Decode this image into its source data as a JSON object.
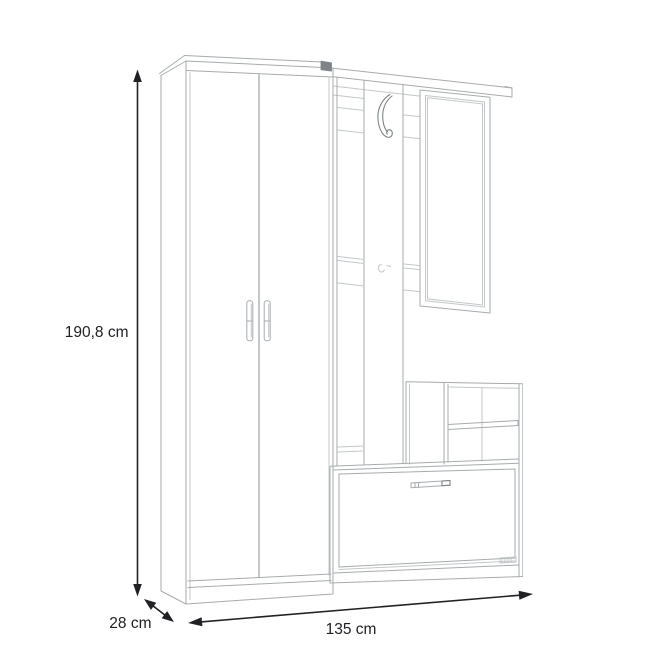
{
  "drawing": {
    "kind": "furniture dimension line drawing",
    "dimensions": {
      "height_label": "190,8 cm",
      "depth_label": "28 cm",
      "width_label": "135 cm"
    },
    "colors": {
      "line": "#a6abad",
      "light": "#c3c7c9",
      "dark": "#7e8487",
      "dim": "#202124",
      "bg": "#ffffff"
    }
  }
}
